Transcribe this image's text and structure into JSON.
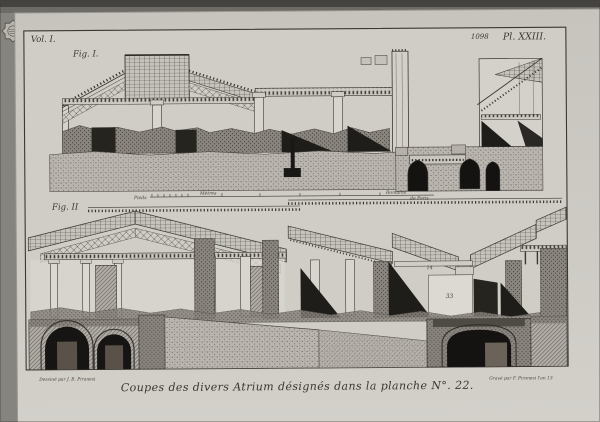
{
  "plate": {
    "volume_label": "Vol. I.",
    "page_number": "1098",
    "plate_label": "Pl. XXIII.",
    "fig1_label": "Fig. I.",
    "fig2_label": "Fig. II",
    "caption": "Coupes des divers Atrium désignés dans la planche N°. 22.",
    "signature_left": "Dessiné par J. B. Piranesi",
    "signature_right": "Gravé par F. Piranesi l'an 13",
    "scale": {
      "left_label": "Pieds",
      "mid_label": "Mètres",
      "right_label": "Romains",
      "far_right_label": "de Paris"
    },
    "annotations": {
      "beam_number": "14",
      "room_number": "33"
    },
    "icons": {
      "stamp": "collection-stamp"
    }
  },
  "colors": {
    "photo_background": "#86847f",
    "paper": "#cbc8c2",
    "ink": "#3a3733",
    "deep_shadow": "#161513"
  }
}
